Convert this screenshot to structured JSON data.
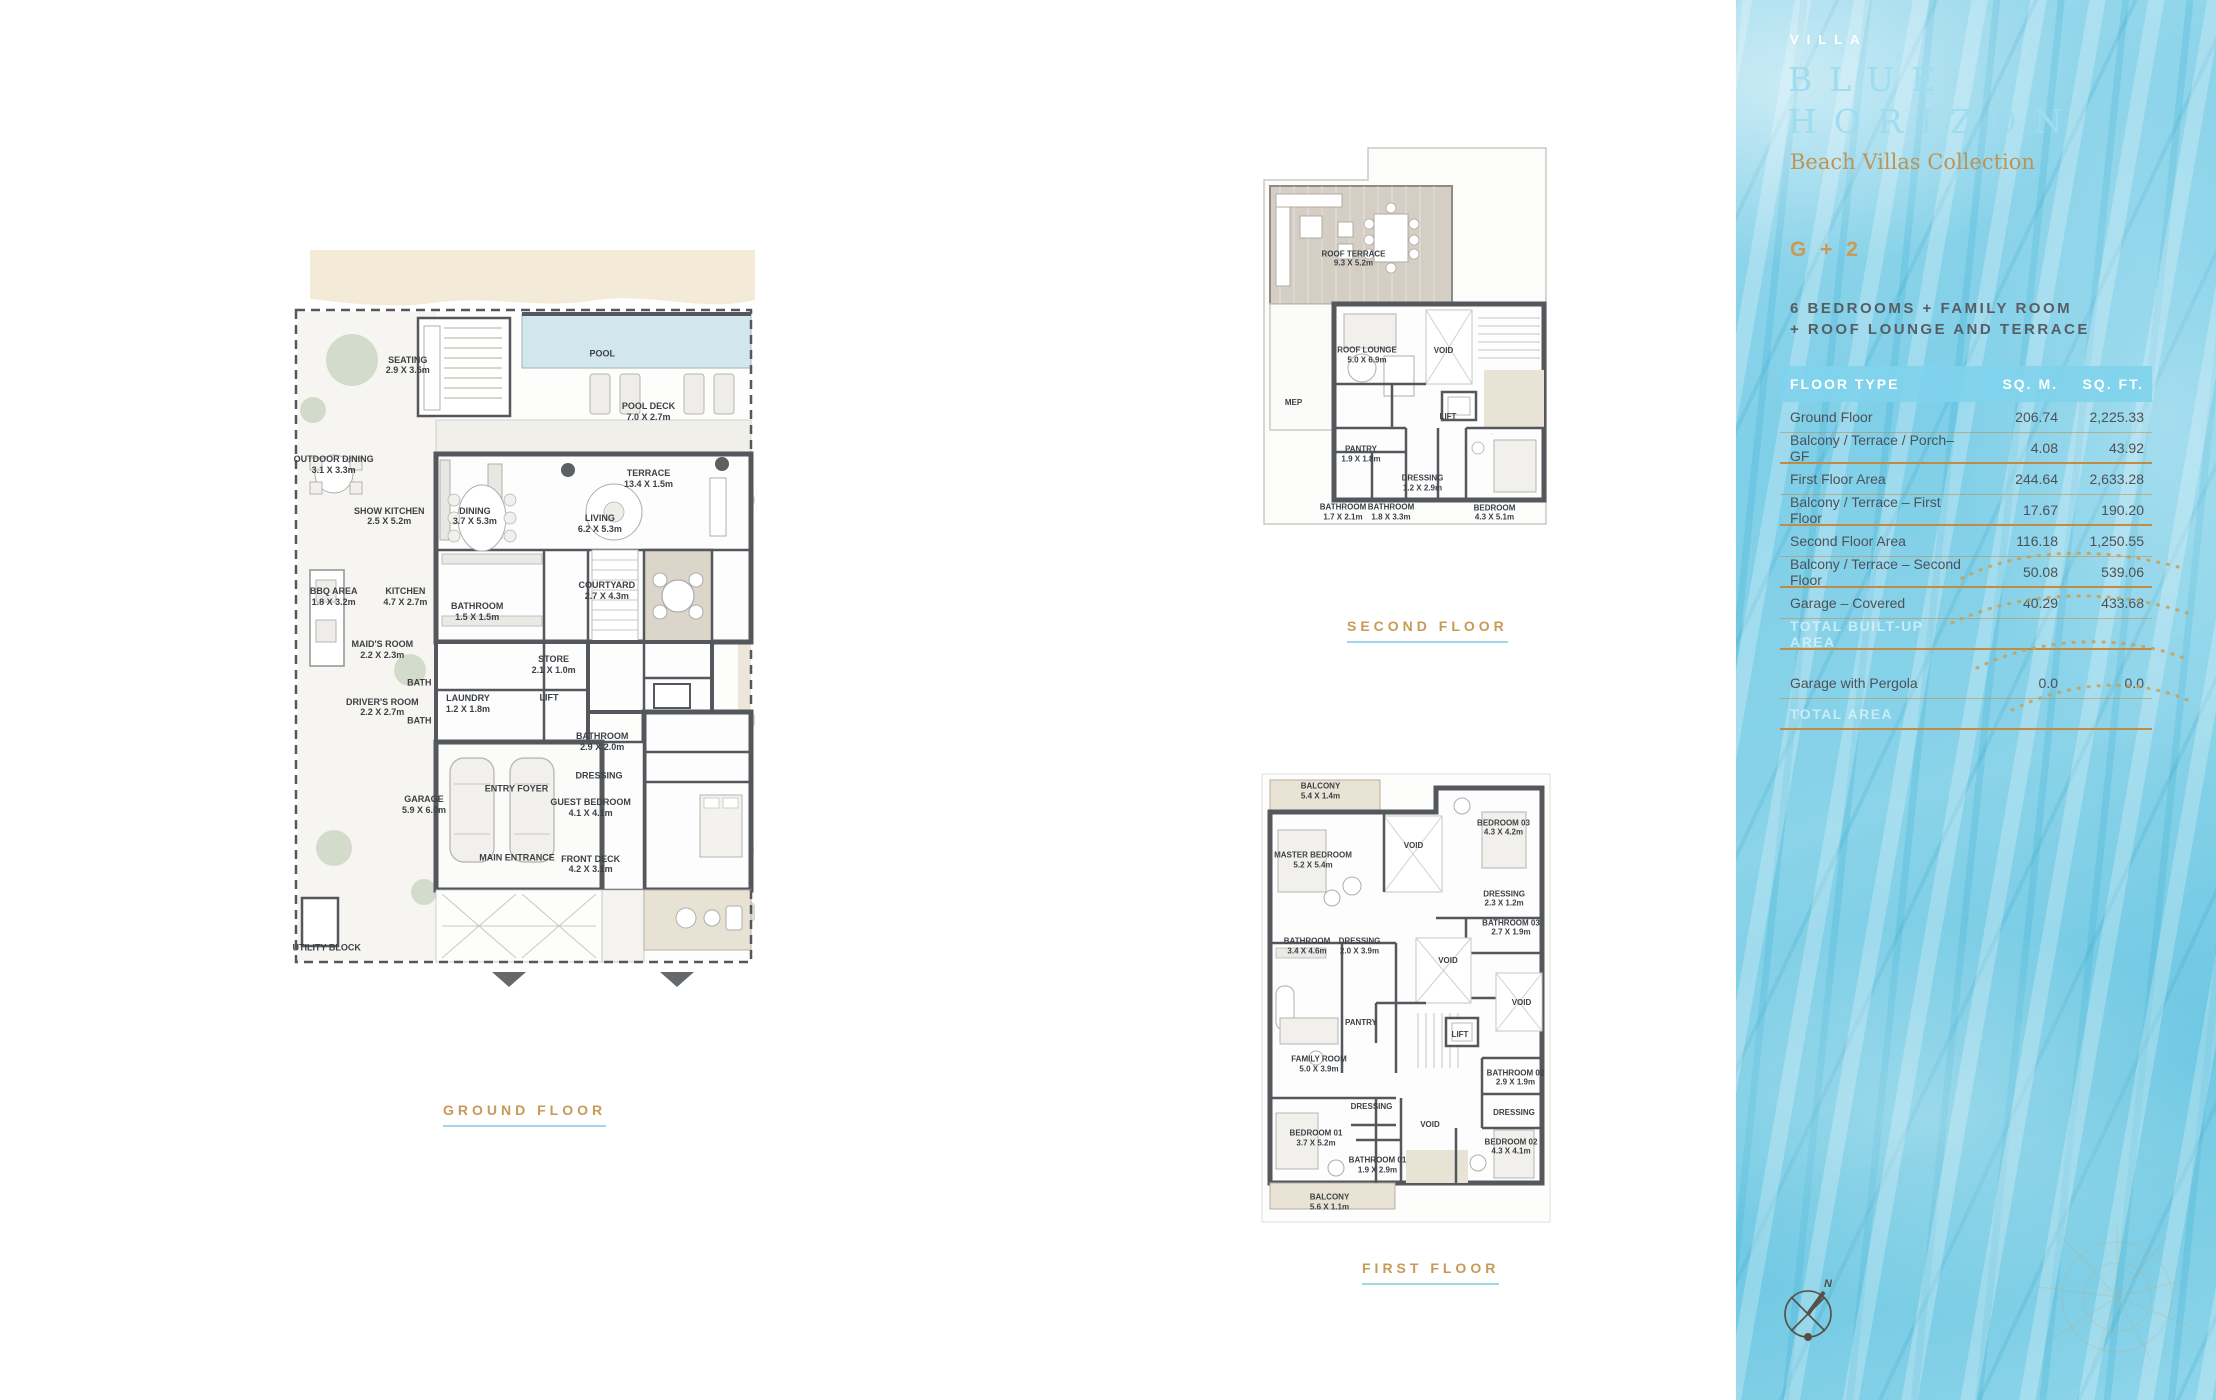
{
  "sidebar": {
    "brand": {
      "villa": "VILLA",
      "line1": "BLUE",
      "line2": "HORIZON",
      "collection": "Beach Villas Collection"
    },
    "unit_type": "G + 2",
    "description_line1": "6 BEDROOMS + FAMILY ROOM",
    "description_line2": "+ ROOF LOUNGE AND TERRACE",
    "table": {
      "headers": [
        "FLOOR TYPE",
        "SQ. M.",
        "SQ. FT."
      ],
      "rows": [
        {
          "label": "Ground Floor",
          "sqm": "206.74",
          "sqft": "2,225.33",
          "divider": "thin"
        },
        {
          "label": "Balcony / Terrace / Porch–GF",
          "sqm": "4.08",
          "sqft": "43.92",
          "divider": "thick"
        },
        {
          "label": "First Floor Area",
          "sqm": "244.64",
          "sqft": "2,633.28",
          "divider": "thin"
        },
        {
          "label": "Balcony / Terrace – First Floor",
          "sqm": "17.67",
          "sqft": "190.20",
          "divider": "thick"
        },
        {
          "label": "Second Floor Area",
          "sqm": "116.18",
          "sqft": "1,250.55",
          "divider": "thin"
        },
        {
          "label": "Balcony / Terrace – Second Floor",
          "sqm": "50.08",
          "sqft": "539.06",
          "divider": "thick"
        },
        {
          "label": "Garage – Covered",
          "sqm": "40.29",
          "sqft": "433.68",
          "divider": "thin"
        },
        {
          "label": "TOTAL BUILT-UP AREA",
          "sqm": "",
          "sqft": "",
          "divider": "thick",
          "style": "total",
          "gap": true
        },
        {
          "label": "Garage with Pergola",
          "sqm": "0.0",
          "sqft": "0.0",
          "divider": "thin"
        },
        {
          "label": "TOTAL AREA",
          "sqm": "",
          "sqft": "",
          "divider": "thick",
          "style": "total"
        }
      ]
    },
    "compass_label": "N"
  },
  "plans": {
    "ground": {
      "caption": "GROUND FLOOR",
      "rooms": [
        {
          "name": "SEATING",
          "dims": "2.9 X 3.5m",
          "x": 25,
          "y": 15.3
        },
        {
          "name": "POOL",
          "dims": "",
          "x": 67,
          "y": 13.8
        },
        {
          "name": "POOL DECK",
          "dims": "7.0 X 2.7m",
          "x": 77,
          "y": 21.5
        },
        {
          "name": "TERRACE",
          "dims": "13.4 X 1.5m",
          "x": 77,
          "y": 30.3
        },
        {
          "name": "OUTDOOR DINING",
          "dims": "3.1 X 3.3m",
          "x": 9,
          "y": 28.5
        },
        {
          "name": "SHOW KITCHEN",
          "dims": "2.5 X 5.2m",
          "x": 21,
          "y": 35.3
        },
        {
          "name": "DINING",
          "dims": "3.7 X 5.3m",
          "x": 39.5,
          "y": 35.3
        },
        {
          "name": "LIVING",
          "dims": "6.2 X 5.3m",
          "x": 66.5,
          "y": 36.3
        },
        {
          "name": "BBQ AREA",
          "dims": "1.8 X 3.2m",
          "x": 9,
          "y": 46
        },
        {
          "name": "KITCHEN",
          "dims": "4.7 X 2.7m",
          "x": 24.5,
          "y": 46
        },
        {
          "name": "BATHROOM",
          "dims": "1.5 X 1.5m",
          "x": 40,
          "y": 48
        },
        {
          "name": "COURTYARD",
          "dims": "2.7 X 4.3m",
          "x": 68,
          "y": 45.2
        },
        {
          "name": "MAID'S ROOM",
          "dims": "2.2 X 2.3m",
          "x": 19.5,
          "y": 53
        },
        {
          "name": "BATH",
          "dims": "",
          "x": 27.5,
          "y": 57.3
        },
        {
          "name": "STORE",
          "dims": "2.1 X 1.0m",
          "x": 56.5,
          "y": 55
        },
        {
          "name": "LIFT",
          "dims": "",
          "x": 55.5,
          "y": 59.3
        },
        {
          "name": "DRIVER'S ROOM",
          "dims": "2.2 X 2.7m",
          "x": 19.5,
          "y": 60.6
        },
        {
          "name": "BATH",
          "dims": "",
          "x": 27.5,
          "y": 62.4
        },
        {
          "name": "LAUNDRY",
          "dims": "1.2 X 1.8m",
          "x": 38,
          "y": 60.1
        },
        {
          "name": "BATHROOM",
          "dims": "2.9 X 2.0m",
          "x": 67,
          "y": 65.2
        },
        {
          "name": "DRESSING",
          "dims": "",
          "x": 66.3,
          "y": 69.7
        },
        {
          "name": "GUEST BEDROOM",
          "dims": "4.1 X 4.1m",
          "x": 64.5,
          "y": 73.9
        },
        {
          "name": "GARAGE",
          "dims": "5.9 X 6.0m",
          "x": 28.5,
          "y": 73.5
        },
        {
          "name": "ENTRY FOYER",
          "dims": "",
          "x": 48.5,
          "y": 71.4
        },
        {
          "name": "MAIN ENTRANCE",
          "dims": "",
          "x": 48.6,
          "y": 80.5
        },
        {
          "name": "FRONT DECK",
          "dims": "4.2 X 3.1m",
          "x": 64.5,
          "y": 81.4
        },
        {
          "name": "UTILITY BLOCK",
          "dims": "",
          "x": 7.5,
          "y": 92.5
        }
      ]
    },
    "second": {
      "caption": "SECOND FLOOR",
      "rooms": [
        {
          "name": "ROOF TERRACE",
          "dims": "9.3 X 5.2m",
          "x": 32.5,
          "y": 27.5
        },
        {
          "name": "ROOF LOUNGE",
          "dims": "5.0 X 6.9m",
          "x": 37,
          "y": 48.5
        },
        {
          "name": "VOID",
          "dims": "",
          "x": 62.5,
          "y": 47.5
        },
        {
          "name": "MEP",
          "dims": "",
          "x": 12.5,
          "y": 59
        },
        {
          "name": "LIFT",
          "dims": "",
          "x": 64,
          "y": 62
        },
        {
          "name": "PANTRY",
          "dims": "1.9 X 1.8m",
          "x": 35,
          "y": 70
        },
        {
          "name": "DRESSING",
          "dims": "1.2 X 2.9m",
          "x": 55.5,
          "y": 76.3
        },
        {
          "name": "BATHROOM",
          "dims": "1.7 X 2.1m",
          "x": 29,
          "y": 82.7
        },
        {
          "name": "BATHROOM",
          "dims": "1.8 X 3.3m",
          "x": 45,
          "y": 82.7
        },
        {
          "name": "BEDROOM",
          "dims": "4.3 X 5.1m",
          "x": 79.5,
          "y": 82.8
        }
      ]
    },
    "first": {
      "caption": "FIRST FLOOR",
      "rooms": [
        {
          "name": "BALCONY",
          "dims": "5.4 X 1.4m",
          "x": 21.5,
          "y": 5
        },
        {
          "name": "MASTER BEDROOM",
          "dims": "5.2 X 5.4m",
          "x": 19,
          "y": 20
        },
        {
          "name": "VOID",
          "dims": "",
          "x": 52.5,
          "y": 17
        },
        {
          "name": "BEDROOM 03",
          "dims": "4.3 X 4.2m",
          "x": 82.5,
          "y": 13
        },
        {
          "name": "DRESSING",
          "dims": "2.3 X 1.2m",
          "x": 82.7,
          "y": 28.4
        },
        {
          "name": "BATHROOM 03",
          "dims": "2.7 X 1.9m",
          "x": 85,
          "y": 34.7
        },
        {
          "name": "BATHROOM",
          "dims": "3.4 X 4.6m",
          "x": 17,
          "y": 38.8
        },
        {
          "name": "DRESSING",
          "dims": "2.0 X 3.9m",
          "x": 34.5,
          "y": 38.8
        },
        {
          "name": "VOID",
          "dims": "",
          "x": 64,
          "y": 42
        },
        {
          "name": "PANTRY",
          "dims": "",
          "x": 35,
          "y": 55.5
        },
        {
          "name": "FAMILY ROOM",
          "dims": "5.0 X 3.9m",
          "x": 21,
          "y": 64.4
        },
        {
          "name": "LIFT",
          "dims": "",
          "x": 68,
          "y": 58
        },
        {
          "name": "VOID",
          "dims": "",
          "x": 88.5,
          "y": 51
        },
        {
          "name": "BATHROOM 02",
          "dims": "2.9 X 1.9m",
          "x": 86.5,
          "y": 67.3
        },
        {
          "name": "DRESSING",
          "dims": "",
          "x": 86,
          "y": 75
        },
        {
          "name": "BEDROOM 01",
          "dims": "3.7 X 5.2m",
          "x": 20,
          "y": 80.5
        },
        {
          "name": "DRESSING",
          "dims": "",
          "x": 38.5,
          "y": 73.6
        },
        {
          "name": "BATHROOM 01",
          "dims": "1.9 X 2.9m",
          "x": 40.5,
          "y": 86.4
        },
        {
          "name": "VOID",
          "dims": "",
          "x": 58,
          "y": 77.5
        },
        {
          "name": "BEDROOM 02",
          "dims": "4.3 X 4.1m",
          "x": 85,
          "y": 82.3
        },
        {
          "name": "BALCONY",
          "dims": "5.6 X 1.1m",
          "x": 24.5,
          "y": 94.4
        }
      ]
    }
  },
  "colors": {
    "gold": "#c89a57",
    "underline_blue": "#9fd6ea",
    "wall": "#54575b",
    "pool": "#d2e6ed",
    "sand": "#f3ebd8",
    "deck": "#d5cec5",
    "header_band": "#80d3eb"
  }
}
